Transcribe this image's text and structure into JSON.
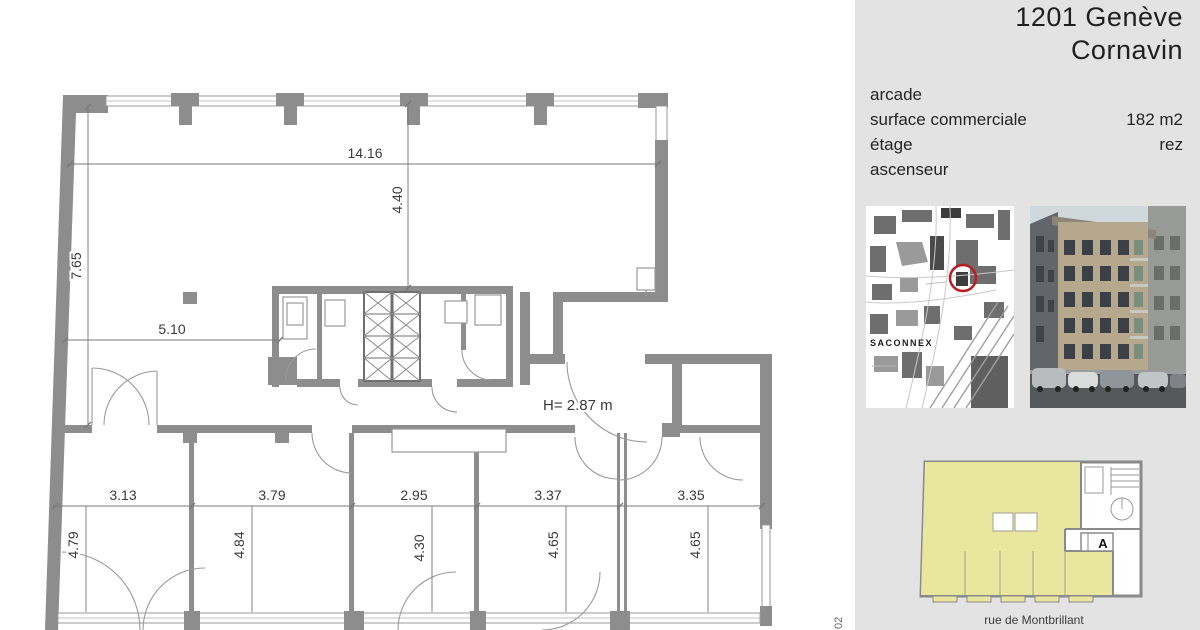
{
  "sidebar": {
    "title_line1": "1201 Genève",
    "title_line2": "Cornavin",
    "details": [
      {
        "label": "arcade",
        "value": ""
      },
      {
        "label": "surface commerciale",
        "value": "182 m2"
      },
      {
        "label": "étage",
        "value": "rez"
      },
      {
        "label": "ascenseur",
        "value": ""
      }
    ],
    "map_label": "SACONNEX",
    "unit_marker": "A",
    "street_label": "rue de Montbrillant",
    "colors": {
      "panel_bg": "#e3e3e3",
      "highlight_yellow": "#e9e79e",
      "marker_red": "#b52025"
    }
  },
  "plan": {
    "height_note": "H= 2.87 m",
    "ref_code": "02",
    "dims": {
      "top_width": "14.16",
      "top_depth": "4.40",
      "left_height": "7.65",
      "left_width": "5.10",
      "rooms_w": [
        "3.13",
        "3.79",
        "2.95",
        "3.37",
        "3.35"
      ],
      "rooms_d": [
        "4.79",
        "4.84",
        "4.30",
        "4.65",
        "4.65"
      ]
    },
    "colors": {
      "wall": "#8d8d8d",
      "dim_line": "#787878"
    }
  }
}
